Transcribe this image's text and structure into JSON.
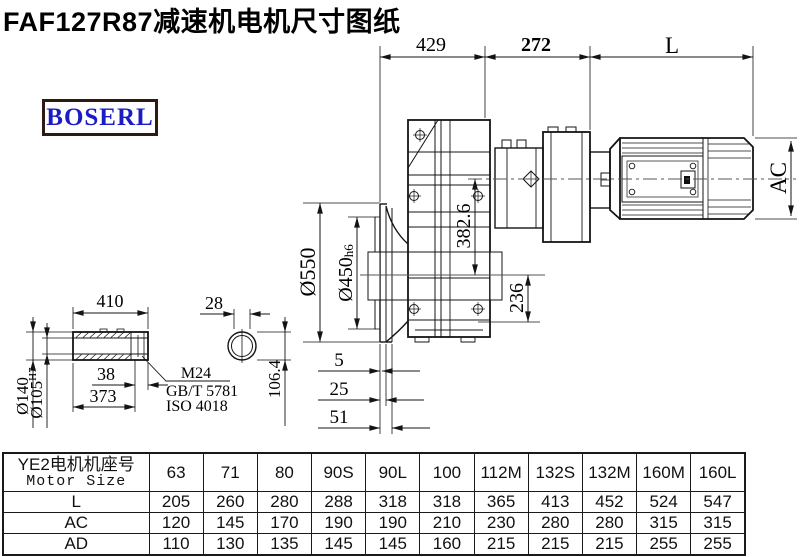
{
  "page": {
    "title": "FAF127R87减速机电机尺寸图纸"
  },
  "logo": {
    "text": "BOSERL"
  },
  "drawing": {
    "labels": {
      "dim_429": "429",
      "dim_272": "272",
      "dim_L": "L",
      "dim_AC": "AC",
      "dia_550": "Ø550",
      "dia_450": "Ø450",
      "dia_450_tol": "h6",
      "dim_382_6": "382.6",
      "dim_236": "236",
      "dim_5": "5",
      "dim_25": "25",
      "dim_51": "51",
      "shaft_410": "410",
      "shaft_38": "38",
      "shaft_373": "373",
      "dia_140": "Ø140",
      "dia_105": "Ø105",
      "dia_105_tol": "H7",
      "dim_28": "28",
      "dim_106_4": "106.4",
      "leader_m24": "M24",
      "leader_gb": "GB/T 5781",
      "leader_iso": "ISO 4018"
    },
    "line_color": "#141414"
  },
  "table": {
    "header_cn": "YE2电机机座号",
    "header_en": "Motor Size",
    "columns": [
      "63",
      "71",
      "80",
      "90S",
      "90L",
      "100",
      "112M",
      "132S",
      "132M",
      "160M",
      "160L"
    ],
    "rows": [
      {
        "label": "L",
        "values": [
          205,
          260,
          280,
          288,
          318,
          318,
          365,
          413,
          452,
          524,
          547
        ]
      },
      {
        "label": "AC",
        "values": [
          120,
          145,
          170,
          190,
          190,
          210,
          230,
          280,
          280,
          315,
          315
        ]
      },
      {
        "label": "AD",
        "values": [
          110,
          130,
          135,
          145,
          145,
          160,
          215,
          215,
          215,
          255,
          255
        ]
      }
    ]
  }
}
